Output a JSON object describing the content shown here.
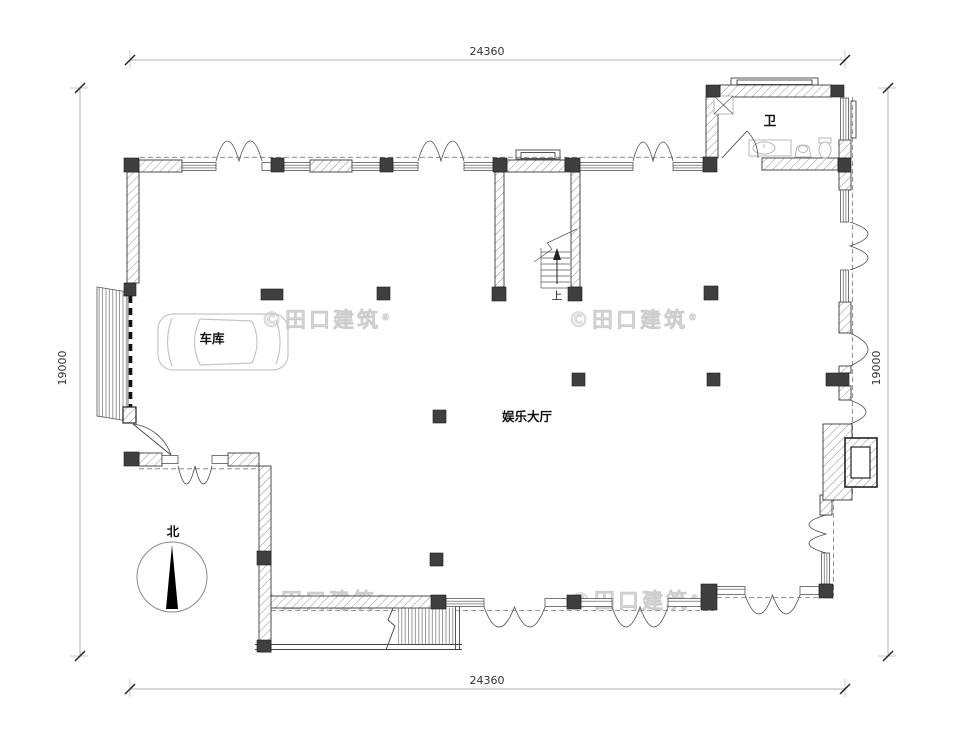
{
  "dimensions": {
    "top": "24360",
    "bottom": "24360",
    "left": "19000",
    "right": "19000"
  },
  "labels": {
    "garage": "车库",
    "hall": "娱乐大厅",
    "bathroom": "卫",
    "north": "北",
    "stairs_up": "上"
  },
  "watermark": {
    "text": "©田口建筑",
    "registered": "®"
  },
  "colors": {
    "paper": "#ffffff",
    "linework": "#3a3a3a",
    "column": "#3f3f3f",
    "dimension_line": "#b2b2b2",
    "watermark_gray": "#e3e3e3",
    "fixture_gray": "#b7b7b7"
  }
}
